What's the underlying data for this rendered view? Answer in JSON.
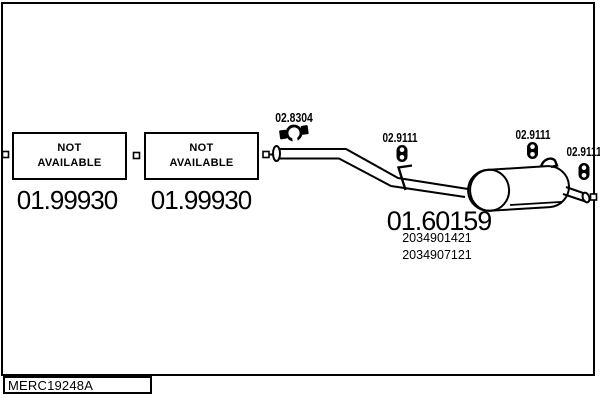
{
  "colors": {
    "line": "#000000",
    "background": "#ffffff"
  },
  "boxes": [
    {
      "status": "NOT\nAVAILABLE",
      "part_number": "01.99930"
    },
    {
      "status": "NOT\nAVAILABLE",
      "part_number": "01.99930"
    }
  ],
  "labels": {
    "clamp": "02.8304",
    "hanger_front": "02.9111",
    "hanger_mid": "02.9111",
    "hanger_rear": "02.9111"
  },
  "silencer": {
    "part_number": "01.60159",
    "oem_1": "2034901421",
    "oem_2": "2034907121"
  },
  "footer": {
    "drawing_code": "MERC19248A"
  },
  "icons": {
    "clamp": "pipe-clamp-icon",
    "hanger": "rubber-hanger-icon",
    "flange": "pipe-flange-icon",
    "connector": "connector-square-icon"
  }
}
